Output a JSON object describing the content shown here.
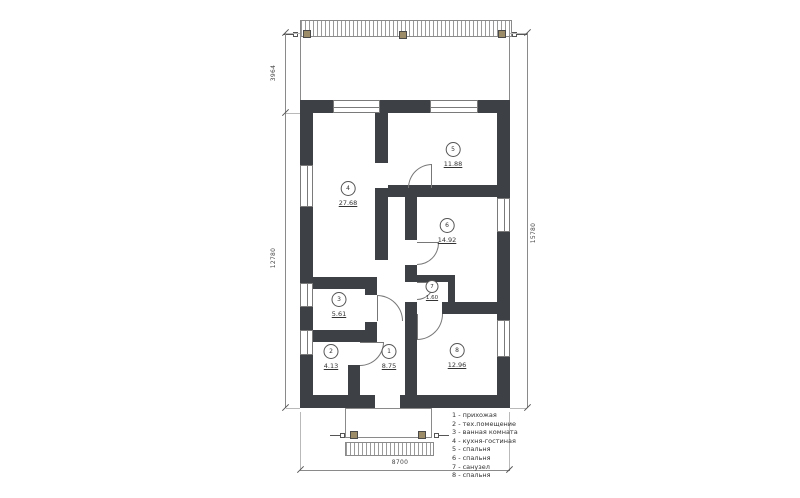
{
  "rooms": [
    {
      "num": "1",
      "area": "8.75"
    },
    {
      "num": "2",
      "area": "4.13"
    },
    {
      "num": "3",
      "area": "5.61"
    },
    {
      "num": "4",
      "area": "27.68"
    },
    {
      "num": "5",
      "area": "11.88"
    },
    {
      "num": "6",
      "area": "14.92"
    },
    {
      "num": "7",
      "area": "1.60"
    },
    {
      "num": "8",
      "area": "12.96"
    }
  ],
  "legend": {
    "items": [
      "1 - прихожая",
      "2 - тех.помещение",
      "3 - ванная комната",
      "4 - кухня-гостиная",
      "5 - спальня",
      "6 - спальня",
      "7 - санузел",
      "8 - спальня"
    ]
  },
  "dimensions": {
    "terrace_depth": "3964",
    "house_length": "12780",
    "total_length": "15780",
    "house_width": "8700"
  },
  "colors": {
    "wall": "#3d4044",
    "line": "#8a8a8a",
    "post": "#9c8c68",
    "background": "#ffffff"
  }
}
